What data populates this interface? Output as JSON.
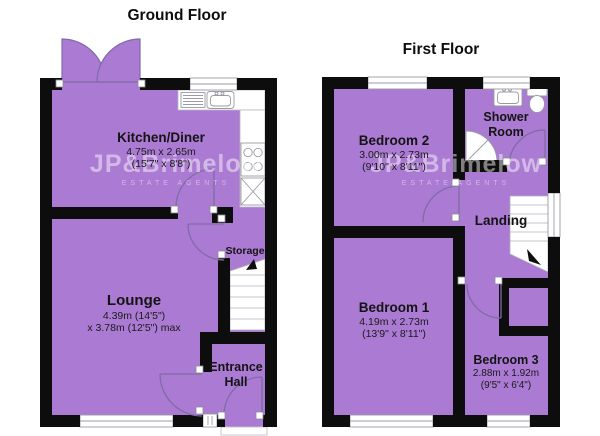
{
  "colors": {
    "room_fill": "#ab7ad2",
    "wall": "#0d0d0d",
    "door_arc": "#7f6ba6",
    "fixture_outline": "#9a9aa6"
  },
  "watermark": {
    "brand": "JP&Brimelow",
    "tagline": "ESTATE AGENTS"
  },
  "ground_floor": {
    "title": "Ground Floor",
    "kitchen": {
      "name": "Kitchen/Diner",
      "metric": "4.75m x 2.65m",
      "imperial": "(15'7\" x 8'8\")"
    },
    "lounge": {
      "name": "Lounge",
      "metric": "4.39m (14'5\")",
      "metric2": "x 3.78m (12'5\") max"
    },
    "storage": {
      "name": "Storage"
    },
    "entrance_hall": {
      "line1": "Entrance",
      "line2": "Hall"
    }
  },
  "first_floor": {
    "title": "First Floor",
    "bedroom2": {
      "name": "Bedroom 2",
      "metric": "3.00m x 2.73m",
      "imperial": "(9'10\" x 8'11\")"
    },
    "shower_room": {
      "line1": "Shower",
      "line2": "Room"
    },
    "landing": {
      "name": "Landing"
    },
    "bedroom1": {
      "name": "Bedroom 1",
      "metric": "4.19m x 2.73m",
      "imperial": "(13'9\" x 8'11\")"
    },
    "bedroom3": {
      "name": "Bedroom 3",
      "metric": "2.88m x 1.92m",
      "imperial": "(9'5\" x 6'4\")"
    }
  }
}
